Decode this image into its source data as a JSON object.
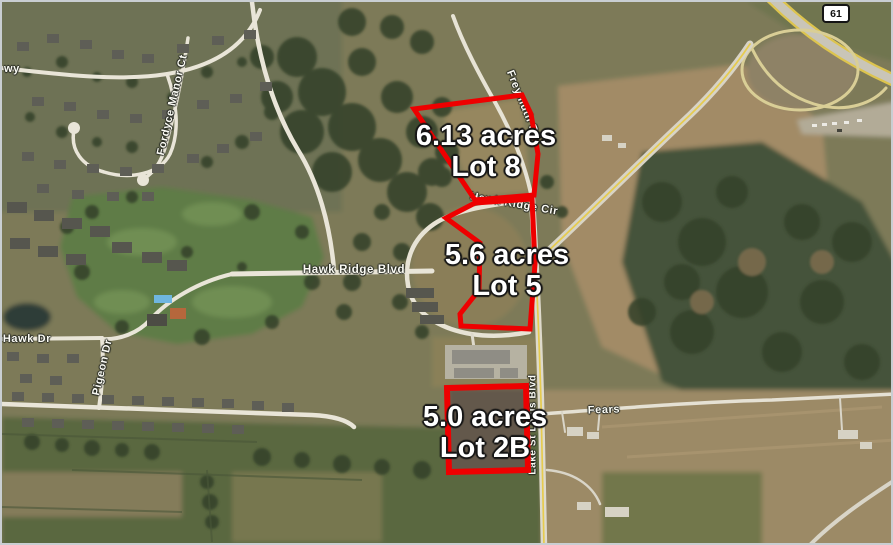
{
  "lots": [
    {
      "id": "lot-8",
      "acres": "6.13 acres",
      "name": "Lot 8",
      "points": "412,107 520,93 529,112 536,152 532,193 473,198"
    },
    {
      "id": "lot-5",
      "acres": "5.6 acres",
      "name": "Lot 5",
      "points": "473,201 444,216 478,241 477,288 458,312 459,324 528,327 533,262 530,197"
    },
    {
      "id": "lot-2b",
      "acres": "5.0 acres",
      "name": "Lot 2B",
      "points": "445,386 524,384 526,468 447,470"
    }
  ],
  "roads": {
    "pkwy_partial": "wy",
    "fordyce_manor_ct": "Fordyce Manor Ct",
    "freymuth_rd": "Freymuth Rd",
    "hawk_ridge_cir": "Hawk Ridge Cir",
    "hawk_ridge_blvd": "Hawk Ridge Blvd",
    "hawk_dr": "Hawk Dr",
    "pigeon_dr": "Pigeon Dr",
    "lake_st_louis_blvd": "Lake St Louis Blvd",
    "fears": "Fears"
  },
  "highway_shield": {
    "route": "61"
  },
  "colors": {
    "lot_outline": "#ee0000",
    "lot_label_text": "#ffffff"
  }
}
